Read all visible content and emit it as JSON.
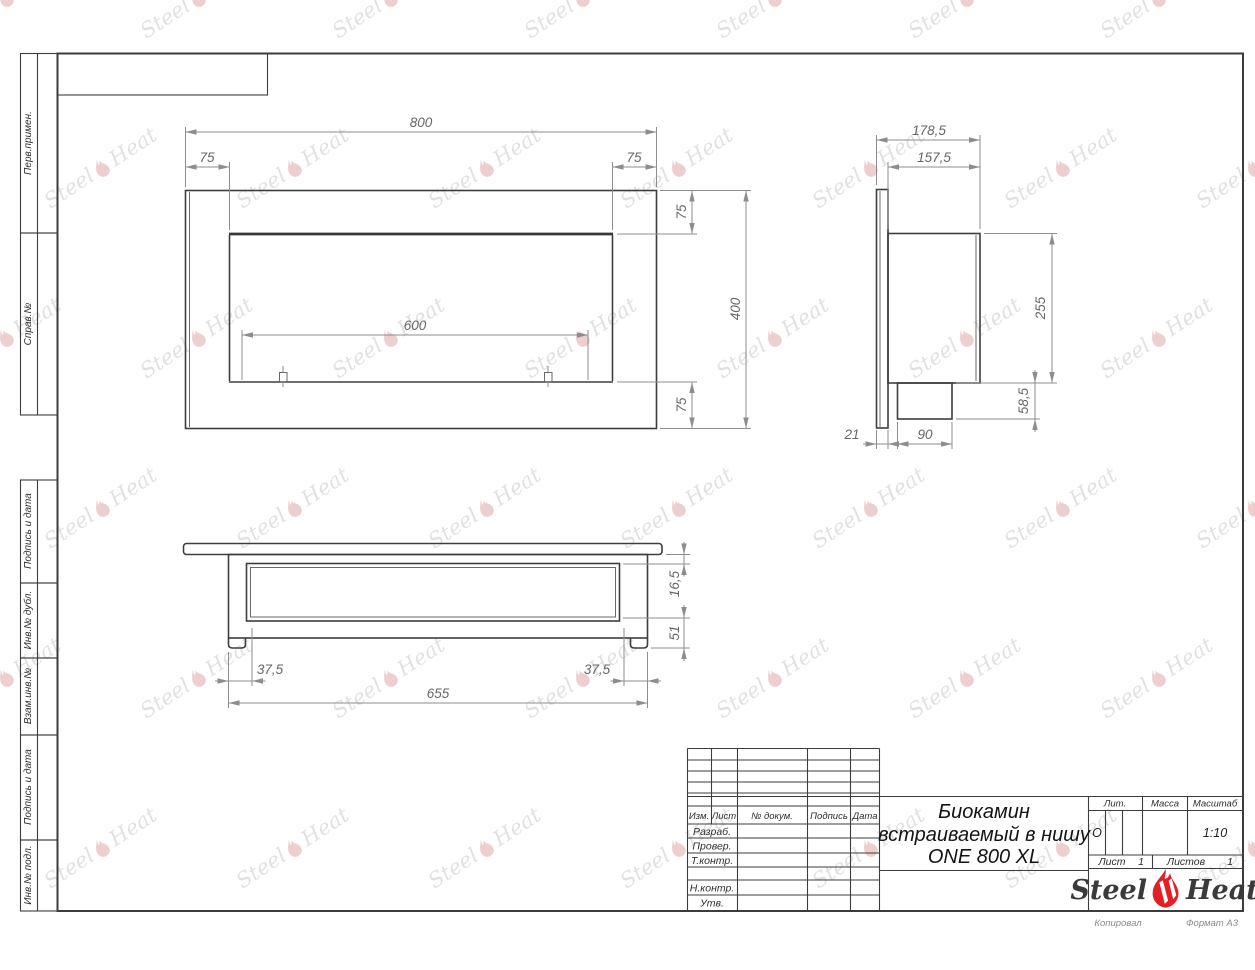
{
  "sidebar": {
    "labels": [
      "Перв.примен.",
      "Справ.№",
      "Подпись и дата",
      "Инв.№ дубл.",
      "Взам.инв.№",
      "Подпись и дата",
      "Инв.№ подл."
    ]
  },
  "dims": {
    "front": {
      "total_width": "800",
      "left_margin": "75",
      "right_margin": "75",
      "opening_width": "600",
      "top_margin": "75",
      "total_height": "400",
      "bottom_margin": "75"
    },
    "side": {
      "total_depth": "178,5",
      "body_depth": "157,5",
      "body_height": "255",
      "duct_height": "58,5",
      "flange_thickness": "21",
      "duct_width": "90"
    },
    "bottom": {
      "flange_gap": "16,5",
      "lower_depth": "51",
      "offset_left": "37,5",
      "offset_right": "37,5",
      "inner_length": "655"
    }
  },
  "title_block": {
    "revision_cols": [
      "Изм.",
      "Лист",
      "№ докум.",
      "Подпись",
      "Дата"
    ],
    "signature_labels": [
      "Разраб.",
      "Провер.",
      "Т.контр.",
      "Н.контр.",
      "Утв."
    ],
    "product_title_lines": [
      "Биокамин",
      "встраиваемый в нишу",
      "ONE 800 XL"
    ],
    "lit_label": "Лит.",
    "lit_value": "О",
    "mass_label": "Масса",
    "scale_label": "Масштаб",
    "scale_value": "1:10",
    "sheet_label": "Лист",
    "sheet_number": "1",
    "sheets_label": "Листов",
    "sheets_total": "1"
  },
  "logo": {
    "steel": "Steel",
    "heat": "Heat",
    "flame_color": "#e31e24"
  },
  "watermark": {
    "steel": "Steel",
    "heat": "Heat"
  },
  "footer": {
    "copied_by": "Копировал",
    "format": "Формат А3"
  }
}
